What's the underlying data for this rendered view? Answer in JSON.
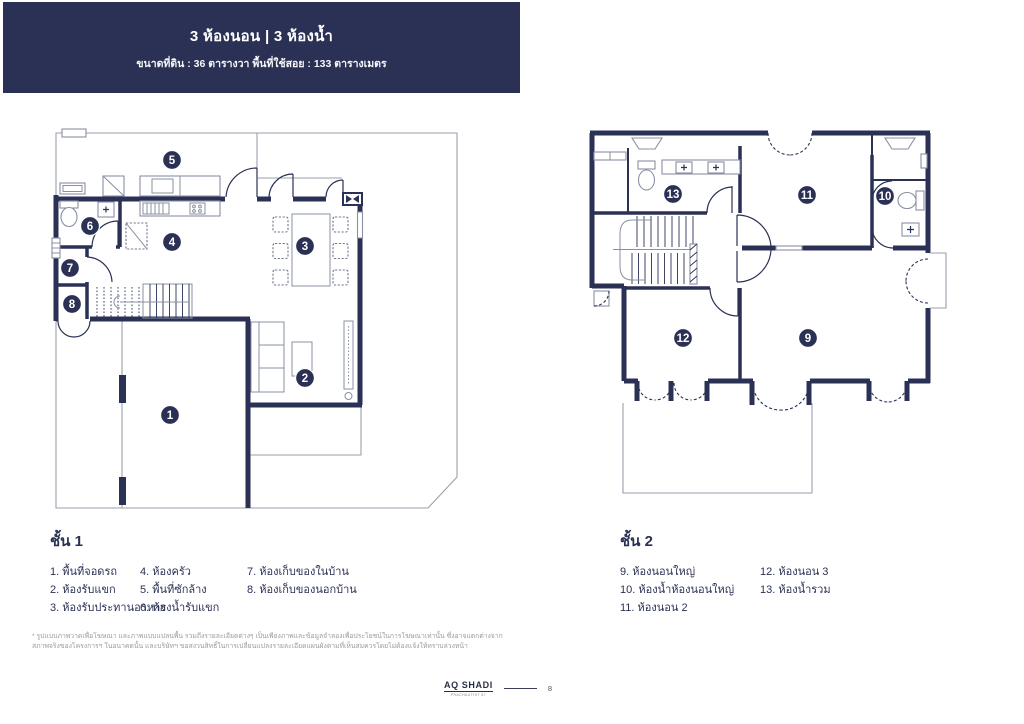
{
  "header": {
    "title": "3 ห้องนอน | 3 ห้องน้ำ",
    "subtitle": "ขนาดที่ดิน : 36 ตารางวา พื้นที่ใช้สอย : 133 ตารางเมตร",
    "bg_color": "#2b3154"
  },
  "floor1": {
    "title": "ชั้น 1",
    "items": [
      "1. พื้นที่จอดรถ",
      "2. ห้องรับแขก",
      "3. ห้องรับประทานอาหาร",
      "4. ห้องครัว",
      "5. พื้นที่ซักล้าง",
      "6. ห้องน้ำรับแขก",
      "7. ห้องเก็บของในบ้าน",
      "8. ห้องเก็บของนอกบ้าน"
    ],
    "markers": [
      "1",
      "2",
      "3",
      "4",
      "5",
      "6",
      "7",
      "8"
    ]
  },
  "floor2": {
    "title": "ชั้น 2",
    "items": [
      "9. ห้องนอนใหญ่",
      "10. ห้องน้ำห้องนอนใหญ่",
      "11. ห้องนอน 2",
      "12. ห้องนอน 3",
      "13. ห้องน้ำรวม"
    ],
    "markers": [
      "9",
      "10",
      "11",
      "12",
      "13"
    ]
  },
  "footnote": "* รูปแบบภาพวาดเพื่อโฆษณา และภาพแบบแปลนพื้น รวมถึงรายละเอียดต่างๆ เป็นเพียงภาพและข้อมูลจำลองเพื่อประโยชน์ในการโฆษณาเท่านั้น ซึ่งอาจแตกต่างจากสภาพจริงของโครงการฯ ในอนาคตนั้น และบริษัทฯ ขอสงวนสิทธิ์ในการเปลี่ยนแปลงรายละเอียดแผนผังตามที่เห็นสมควรโดยไม่ต้องแจ้งให้ทราบล่วงหน้า",
  "footer": {
    "brand": "AQ SHADI",
    "tagline": "PRACHAUTHIT 87",
    "page": "8"
  },
  "colors": {
    "navy": "#2b3154",
    "line_gray": "#9aa0ac",
    "furniture_gray": "#8a90a3"
  }
}
